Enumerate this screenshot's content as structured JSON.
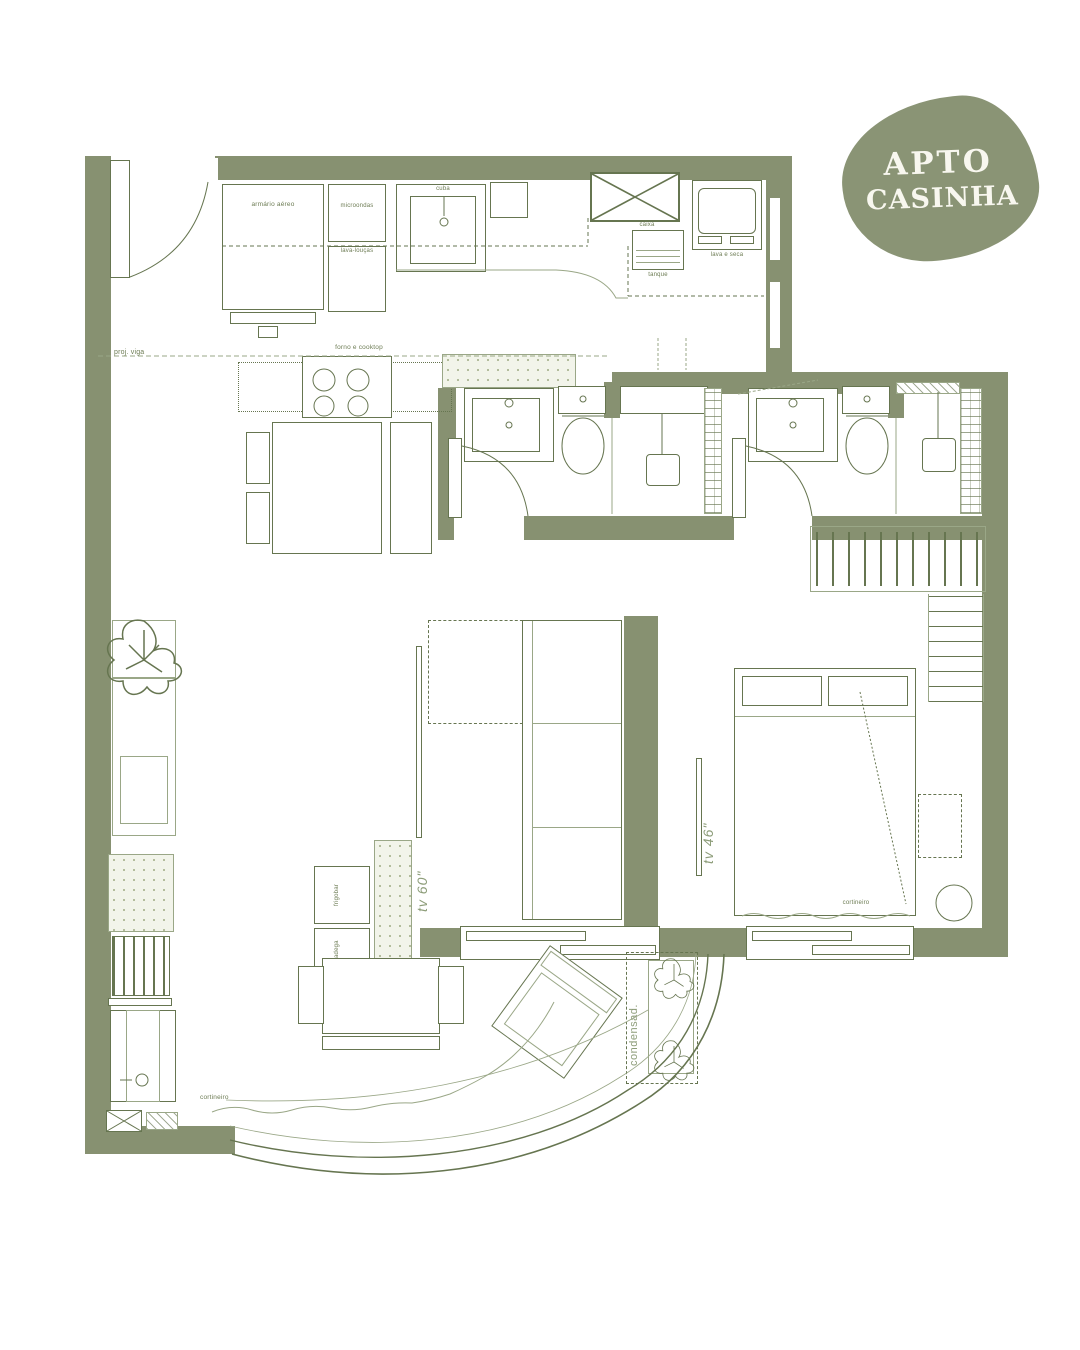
{
  "logo": {
    "line1": "APTO",
    "line2": "CASINHA",
    "blob_color": "#8a9475",
    "text_color": "#f8f7ef"
  },
  "colors": {
    "wall": "#879171",
    "line": "#667550",
    "label": "#6d7c54",
    "speckle_bg": "#f2f4ea"
  },
  "labels": {
    "kitchen": {
      "armario_aereo": "armário aéreo",
      "microondas": "microondas",
      "lava_loucas": "lava-louças",
      "cuba": "cuba",
      "caixa": "caixa",
      "tanque": "tanque",
      "lava_e_seca": "lava e seca",
      "forno_cooktop": "forno e cooktop",
      "proj_viga": "proj. viga"
    },
    "living": {
      "tv60": "tv 60\"",
      "frigobar": "frigobar",
      "adega": "adega"
    },
    "bedroom": {
      "tv46": "tv 46\"",
      "cortineiro": "cortineiro"
    },
    "balcony": {
      "condensadora": "condensad.",
      "cortineiro": "cortineiro"
    }
  }
}
